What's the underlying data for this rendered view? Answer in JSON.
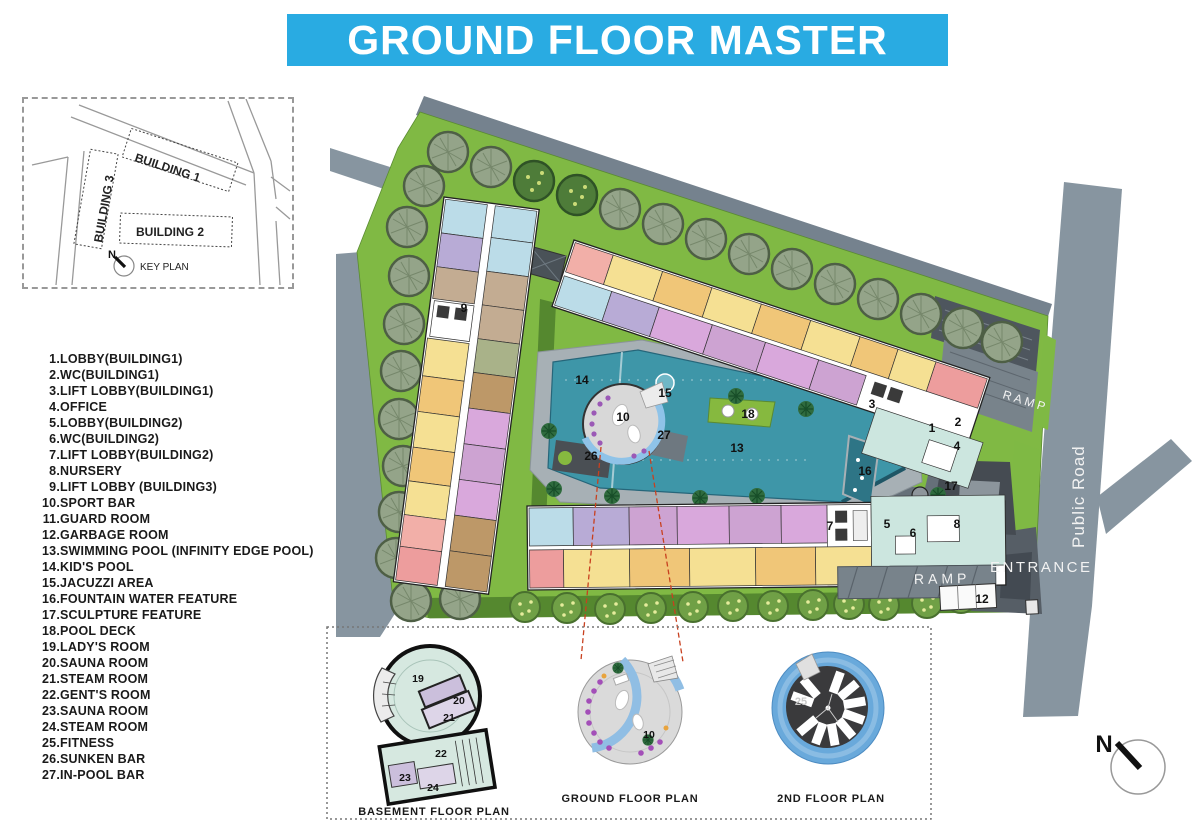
{
  "title": {
    "text": "GROUND FLOOR MASTER PLAN",
    "bg_color": "#29ABE2",
    "text_color": "#FFFFFF"
  },
  "key_plan": {
    "label": "KEY PLAN",
    "north_label": "N",
    "buildings": [
      "BUILDING 1",
      "BUILDING 2",
      "BUILDING 3"
    ]
  },
  "legend": {
    "items": [
      {
        "num": "1.",
        "label": "LOBBY(BUILDING1)"
      },
      {
        "num": "2.",
        "label": "WC(BUILDING1)"
      },
      {
        "num": "3.",
        "label": "LIFT LOBBY(BUILDING1)"
      },
      {
        "num": "4.",
        "label": "OFFICE"
      },
      {
        "num": "5.",
        "label": "LOBBY(BUILDING2)"
      },
      {
        "num": "6.",
        "label": "WC(BUILDING2)"
      },
      {
        "num": "7.",
        "label": "LIFT LOBBY(BUILDING2)"
      },
      {
        "num": "8.",
        "label": "NURSERY"
      },
      {
        "num": "9.",
        "label": "LIFT LOBBY (BUILDING3)"
      },
      {
        "num": "10.",
        "label": "SPORT BAR"
      },
      {
        "num": "11.",
        "label": "GUARD ROOM"
      },
      {
        "num": "12.",
        "label": "GARBAGE ROOM"
      },
      {
        "num": "13.",
        "label": "SWIMMING POOL (INFINITY EDGE POOL)"
      },
      {
        "num": "14.",
        "label": "KID'S POOL"
      },
      {
        "num": "15.",
        "label": "JACUZZI AREA"
      },
      {
        "num": "16.",
        "label": "FOUNTAIN WATER FEATURE"
      },
      {
        "num": "17.",
        "label": "SCULPTURE FEATURE"
      },
      {
        "num": "18.",
        "label": "POOL DECK"
      },
      {
        "num": "19.",
        "label": "LADY'S ROOM"
      },
      {
        "num": "20.",
        "label": "SAUNA ROOM"
      },
      {
        "num": "21.",
        "label": "STEAM ROOM"
      },
      {
        "num": "22.",
        "label": "GENT'S ROOM"
      },
      {
        "num": "23.",
        "label": "SAUNA ROOM"
      },
      {
        "num": "24.",
        "label": "STEAM ROOM"
      },
      {
        "num": "25.",
        "label": "FITNESS"
      },
      {
        "num": "26.",
        "label": "SUNKEN BAR"
      },
      {
        "num": "27.",
        "label": "IN-POOL BAR"
      }
    ]
  },
  "site_plan": {
    "labels": {
      "ramp_top": "RAMP",
      "ramp_bottom": "RAMP",
      "entrance": "ENTRANCE",
      "public_road": "Public Road"
    },
    "colors": {
      "lawn": "#80B944",
      "pool": "#3E96A8",
      "road": "#8795A0",
      "title_cyan": "#29ABE2"
    },
    "markers": [
      {
        "num": "9"
      },
      {
        "num": "14"
      },
      {
        "num": "15"
      },
      {
        "num": "10"
      },
      {
        "num": "27"
      },
      {
        "num": "26"
      },
      {
        "num": "13"
      },
      {
        "num": "18"
      },
      {
        "num": "3"
      },
      {
        "num": "1"
      },
      {
        "num": "2"
      },
      {
        "num": "4"
      },
      {
        "num": "16"
      },
      {
        "num": "17"
      },
      {
        "num": "7"
      },
      {
        "num": "5"
      },
      {
        "num": "6"
      },
      {
        "num": "8"
      },
      {
        "num": "12"
      }
    ]
  },
  "detail_plans": {
    "basement": {
      "label": "BASEMENT FLOOR PLAN",
      "markers": [
        "19",
        "20",
        "21",
        "22",
        "23",
        "24"
      ]
    },
    "ground": {
      "label": "GROUND FLOOR PLAN",
      "markers": [
        "10"
      ]
    },
    "second": {
      "label": "2ND FLOOR PLAN",
      "markers": [
        "25"
      ]
    }
  },
  "compass": {
    "north_label": "N"
  }
}
